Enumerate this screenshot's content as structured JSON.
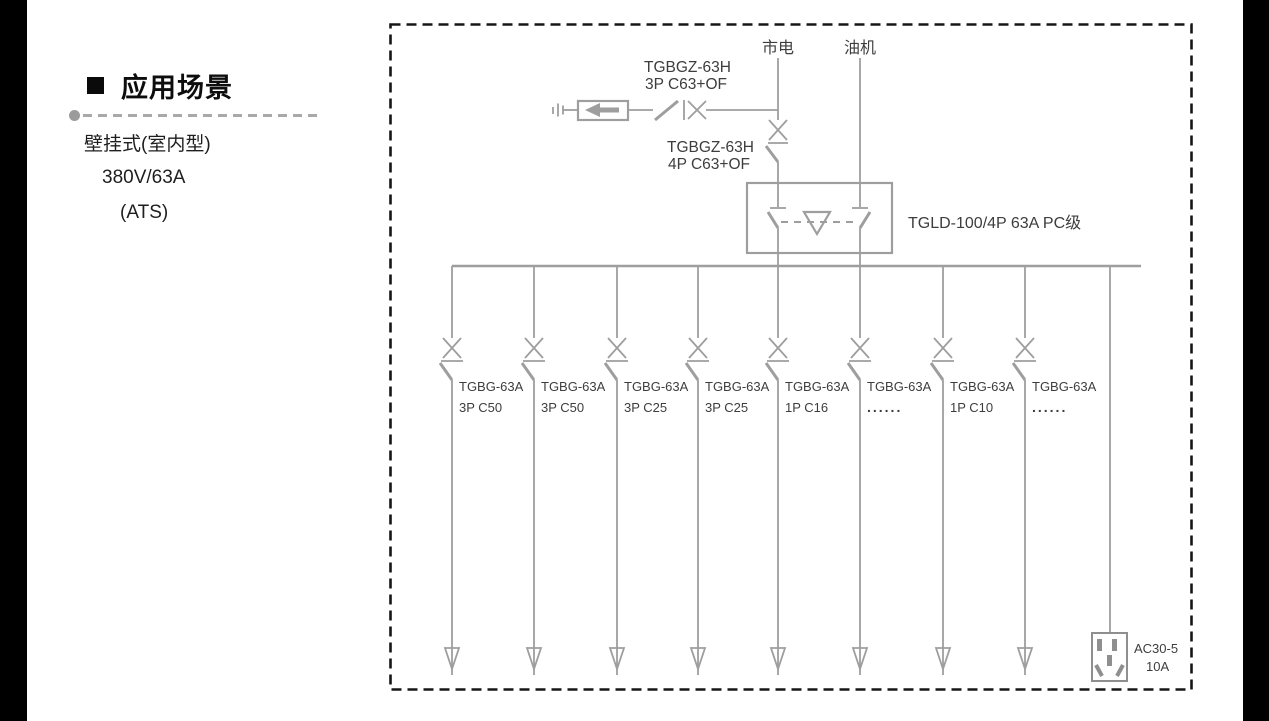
{
  "sidebar": {
    "heading": "应用场景",
    "line1": "壁挂式(室内型)",
    "line2": "380V/63A",
    "line3": "(ATS)"
  },
  "diagram": {
    "sources": {
      "mains": "市电",
      "generator": "油机"
    },
    "spd_breaker": {
      "line1": "TGBGZ-63H",
      "line2": "3P C63+OF"
    },
    "transfer_breaker": {
      "line1": "TGBGZ-63H",
      "line2": "4P C63+OF"
    },
    "ats": {
      "label": "TGLD-100/4P 63A PC级"
    },
    "branches": [
      {
        "model": "TGBG-63A",
        "spec": "3P C50"
      },
      {
        "model": "TGBG-63A",
        "spec": "3P C50"
      },
      {
        "model": "TGBG-63A",
        "spec": "3P C25"
      },
      {
        "model": "TGBG-63A",
        "spec": "3P C25"
      },
      {
        "model": "TGBG-63A",
        "spec": "1P C16"
      },
      {
        "model": "TGBG-63A",
        "spec": "......"
      },
      {
        "model": "TGBG-63A",
        "spec": "1P C10"
      },
      {
        "model": "TGBG-63A",
        "spec": "......"
      }
    ],
    "socket": {
      "line1": "AC30-5",
      "line2": "10A"
    }
  },
  "colors": {
    "diagram_line": "#9e9e9e",
    "diagram_text": "#3d3d3d",
    "border": "#161616",
    "heading": "#0d0d0d"
  }
}
